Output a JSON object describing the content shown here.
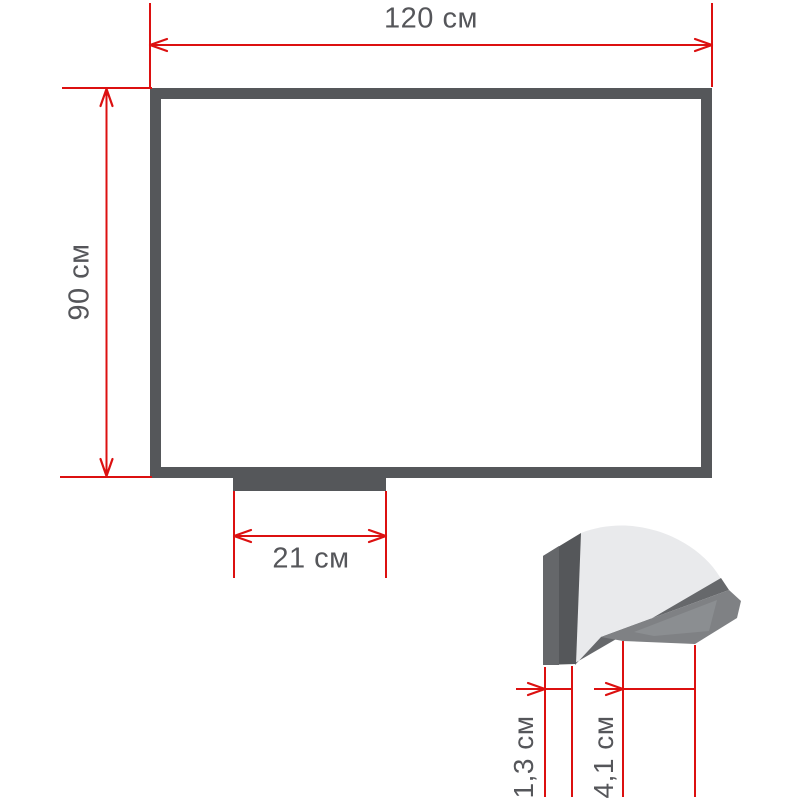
{
  "diagram": {
    "board": {
      "width_label": "120 см",
      "height_label": "90 см",
      "tray_width_label": "21 см"
    },
    "detail": {
      "frame_thickness_label": "1,3 см",
      "tray_depth_label": "4,1 см"
    },
    "colors": {
      "dimension_red": "#dc1010",
      "frame_dark": "#55575a",
      "frame_medium": "#7f8184",
      "surface_light": "#e9eaec",
      "label_gray": "#55565a"
    }
  }
}
